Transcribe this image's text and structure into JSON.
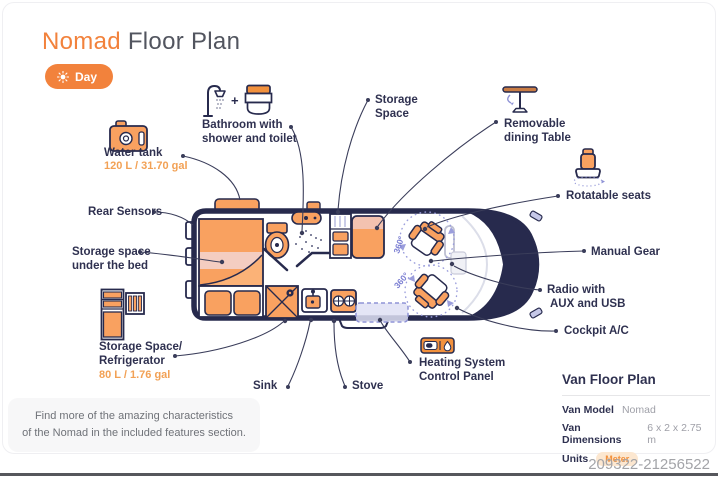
{
  "header": {
    "title_highlight": "Nomad",
    "title_rest": " Floor Plan",
    "mode_toggle": {
      "label": "Day"
    }
  },
  "labels": {
    "bathroom": {
      "line1": "Bathroom with",
      "line2": "shower and toilet",
      "plus": "+"
    },
    "water_tank": {
      "name": "Water tank",
      "capacity": "120 L / 31.70 gal"
    },
    "storage_space": {
      "line1": "Storage",
      "line2": "Space"
    },
    "dining_table": {
      "line1": "Removable",
      "line2": "dining Table"
    },
    "rotatable_seats": {
      "name": "Rotatable seats"
    },
    "manual_gear": {
      "name": "Manual Gear"
    },
    "radio": {
      "line1": "Radio with",
      "line2": "AUX and USB"
    },
    "cockpit_ac": {
      "name": "Cockpit A/C"
    },
    "heating": {
      "line1": "Heating System",
      "line2": "Control Panel"
    },
    "stove": {
      "name": "Stove"
    },
    "sink": {
      "name": "Sink"
    },
    "storage_fridge": {
      "line1": "Storage Space/",
      "line2": "Refrigerator",
      "capacity": "80 L / 1.76 gal"
    },
    "under_bed": {
      "line1": "Storage space",
      "line2": "under the bed"
    },
    "rear_sensors": {
      "name": "Rear Sensors"
    }
  },
  "van": {
    "rotation_label": "360°"
  },
  "info_panel": {
    "title": "Van Floor Plan",
    "rows": [
      {
        "key": "Van Model",
        "value": "Nomad"
      },
      {
        "key": "Van Dimensions",
        "value": "6 x 2 x 2.75 m"
      },
      {
        "key": "Units",
        "value": "Meter"
      }
    ]
  },
  "note": {
    "line1": "Find more of the amazing characteristics",
    "line2": "of the Nomad in the included features section."
  },
  "footer": {
    "id_number": "209322-21256522"
  },
  "colors": {
    "accent": "#F2823C",
    "furniture": "#F9A160",
    "dark": "#272A4D",
    "pink": "#F4CDC1",
    "purple": "#8F93D6",
    "capacity_text": "#F2A155"
  }
}
